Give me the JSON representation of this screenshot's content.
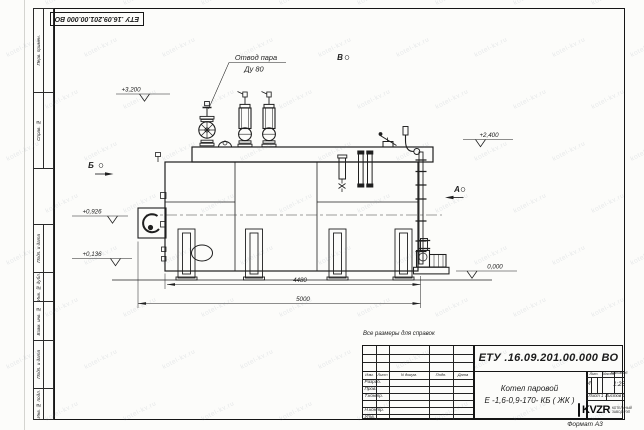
{
  "sheet": {
    "reference_note": "Все размеры для справок",
    "format_label": "Формат А3",
    "watermark": "kotel-kv.ru"
  },
  "colors": {
    "ink": "#1f1f1f",
    "paper": "#fcfcfa"
  },
  "frame_columns": {
    "cells": [
      "Перв. примен.",
      "Справ. №",
      "Подп. и дата",
      "Инв. № дубл.",
      "Взам. инв. №",
      "Подп. и дата",
      "Инв. № подл."
    ]
  },
  "drawing": {
    "annotations": {
      "line1": "Отвод пара",
      "line2": "Ду 80"
    },
    "view_labels": {
      "b": "Б",
      "v": "В",
      "a": "А"
    },
    "elevations": {
      "e3200": "+3,200",
      "e2400": "+2,400",
      "e0926": "+0,926",
      "e0136": "+0,136",
      "e0000": "0,000"
    },
    "dimensions": {
      "d4480": "4480",
      "d5000": "5000"
    }
  },
  "title_block": {
    "designation": "ЕТУ .16.09.201.00.000  ВО",
    "name_line1": "Котел паровой",
    "name_line2": "Е -1,6-0,9-170- КБ ( ЖК )",
    "rev_header": [
      "Изм.",
      "Лист",
      "N докум.",
      "Подп.",
      "Дата"
    ],
    "sig_rows": [
      "Разраб.",
      "Пров.",
      "Т.контр.",
      "",
      "Н.контр.",
      "Утв."
    ],
    "lit_header": [
      "Лит.",
      "Масса",
      "Масштаб"
    ],
    "lit_value": "И",
    "scale_value": "1:25",
    "sheet_label": "Лист 1",
    "sheets_label": "Листов 2",
    "logo_text": "KVZR",
    "logo_caption_line1": "КОТЕЛЬНЫЙ",
    "logo_caption_line2": "ЗАВОД РЭП"
  }
}
